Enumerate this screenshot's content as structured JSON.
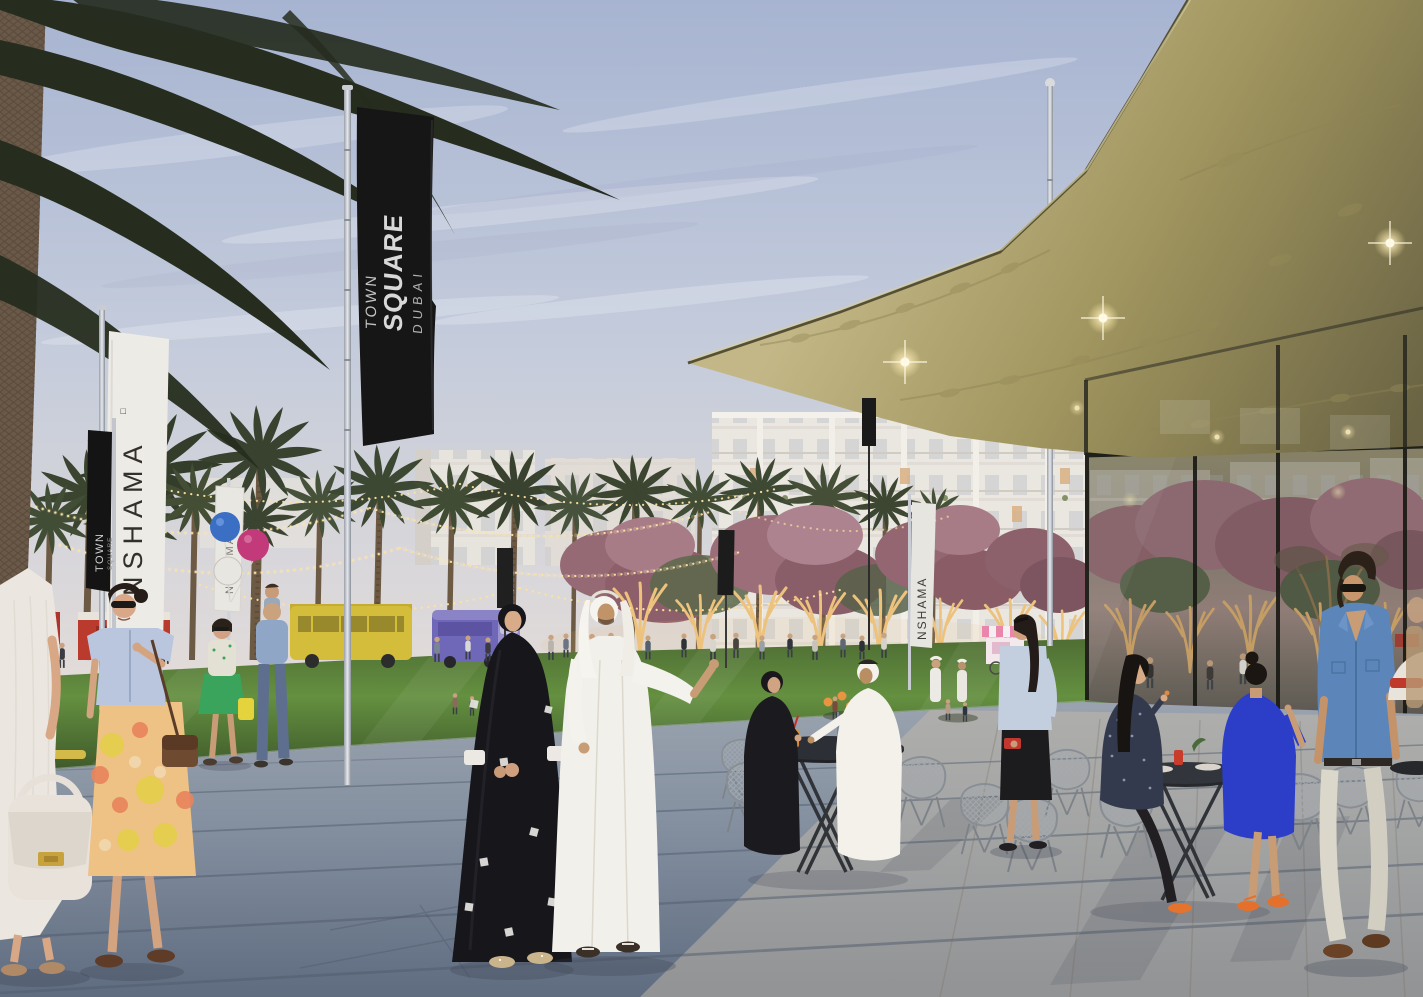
{
  "scene": {
    "type": "architectural-rendering",
    "description": "Town Square Dubai public plaza at dusk: palm grove with string lights, glass pavilion with gold floral canopy, outdoor cafe seating, pedestrians in kandura and abaya, NSHAMA banners, residential buildings behind",
    "banners": {
      "main": {
        "line1": "TOWN",
        "line2": "SQUARE",
        "line3": "DUBAI"
      },
      "nshama_left": {
        "text": "NSHAMA",
        "mark": "□"
      },
      "town_small": {
        "line1": "TOWN",
        "line2": "SQUARE"
      },
      "balloons": {
        "text": "NSHAMA"
      },
      "nshama_park": {
        "text": "NSHAMA"
      }
    },
    "palette": {
      "sky_top": "#a7b4d1",
      "sky_horizon": "#ecdfd8",
      "canopy_gold": "#a1965f",
      "banner_black": "#161616",
      "banner_white": "#edebe6",
      "lawn_green": "#5d8039",
      "pavement_blue_grey": "#8893a3",
      "cafe_stone": "#c3baa9",
      "string_lights": "#ffe2a0",
      "tree_blossom": "#96687a",
      "uplight_gold": "#edc27c",
      "kandura_white": "#f2f0ea",
      "abaya_black": "#17161a",
      "dress_blue": "#2c3ec8",
      "denim_blue": "#5c86ba",
      "balloon_blue": "#3a6fc4",
      "balloon_magenta": "#c23a7a",
      "balloon_white": "#e8e6e0"
    }
  }
}
